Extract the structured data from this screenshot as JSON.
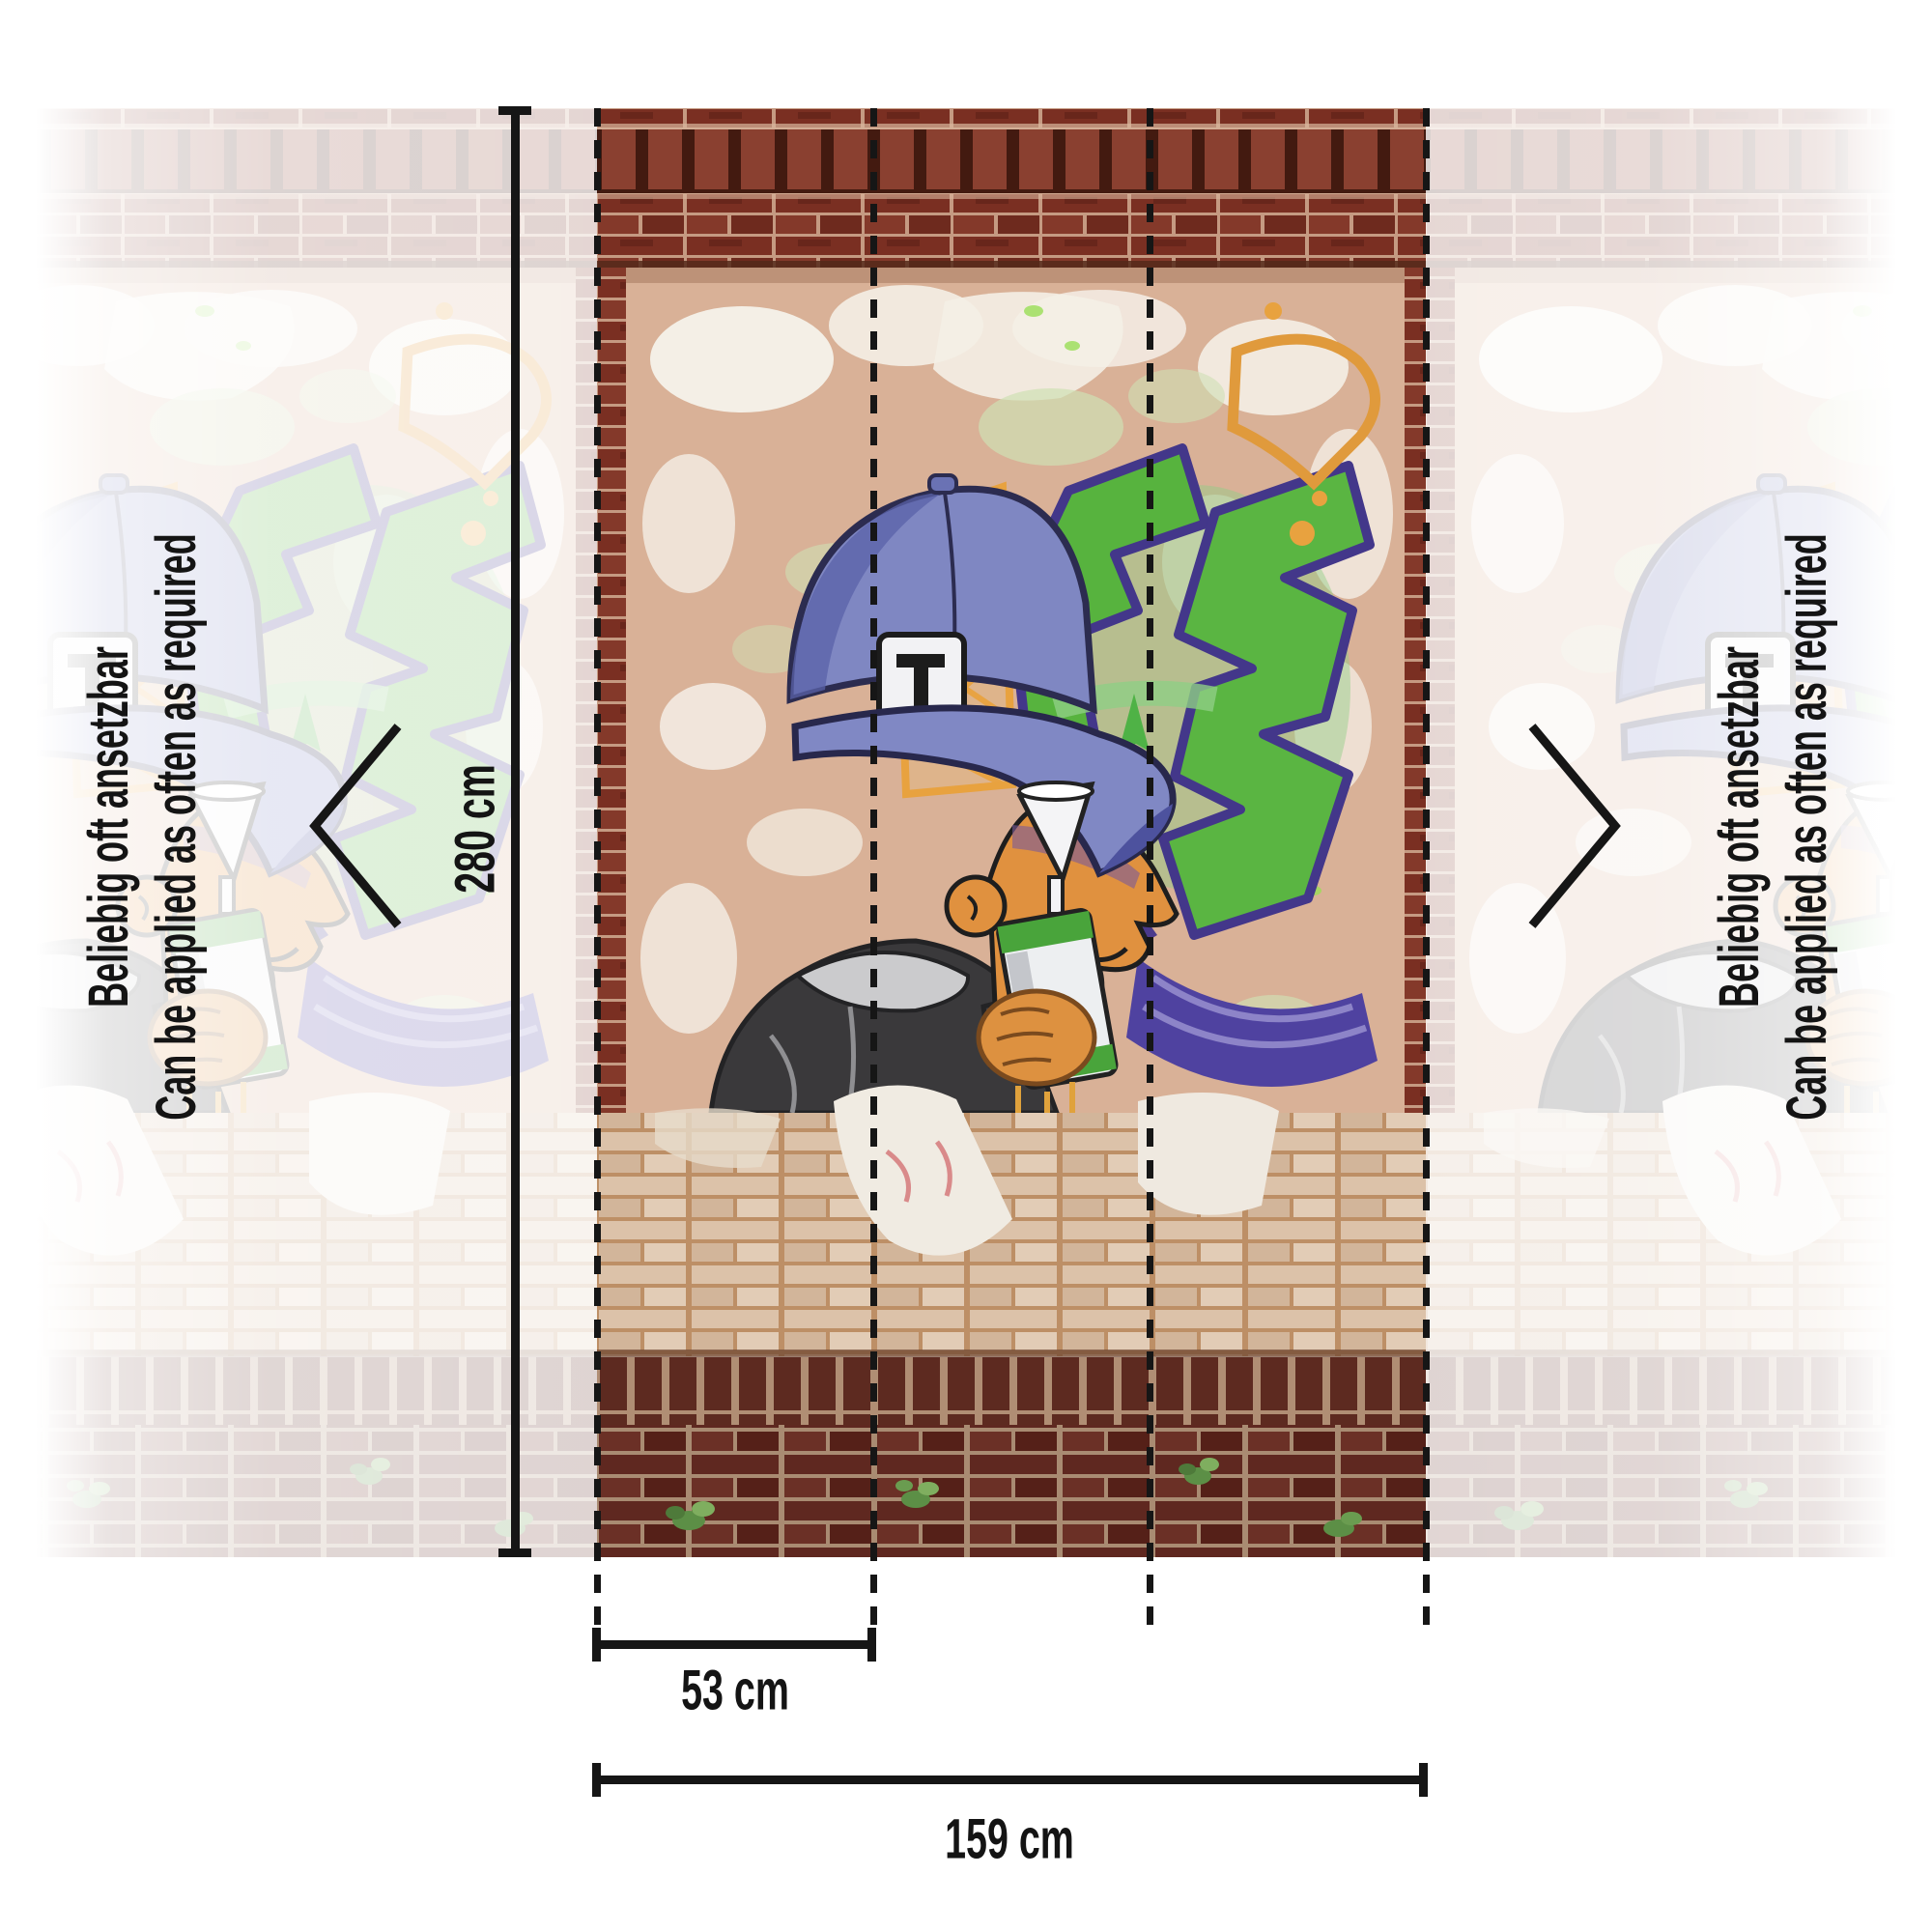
{
  "annotations": {
    "note_de": "Beliebig oft ansetzbar",
    "note_en": "Can be applied as often as required",
    "height_label": "280 cm",
    "panel_width_label": "53 cm",
    "total_width_label": "159 cm"
  },
  "icons": {
    "left_chevron": "chevron-left-icon",
    "right_chevron": "chevron-right-icon"
  },
  "colors": {
    "annotation_ink": "#161616",
    "brick_dark_red": "#7a2f22",
    "brick_tan": "#dcc2a9",
    "brick_base_maroon": "#5f2820",
    "plaster": "#d9b197",
    "graffiti_green": "#57b33e",
    "graffiti_purple": "#4a3a8c",
    "graffiti_orange": "#e8a23f",
    "cap_blue": "#7f87c2",
    "face_orange": "#e0913f"
  }
}
